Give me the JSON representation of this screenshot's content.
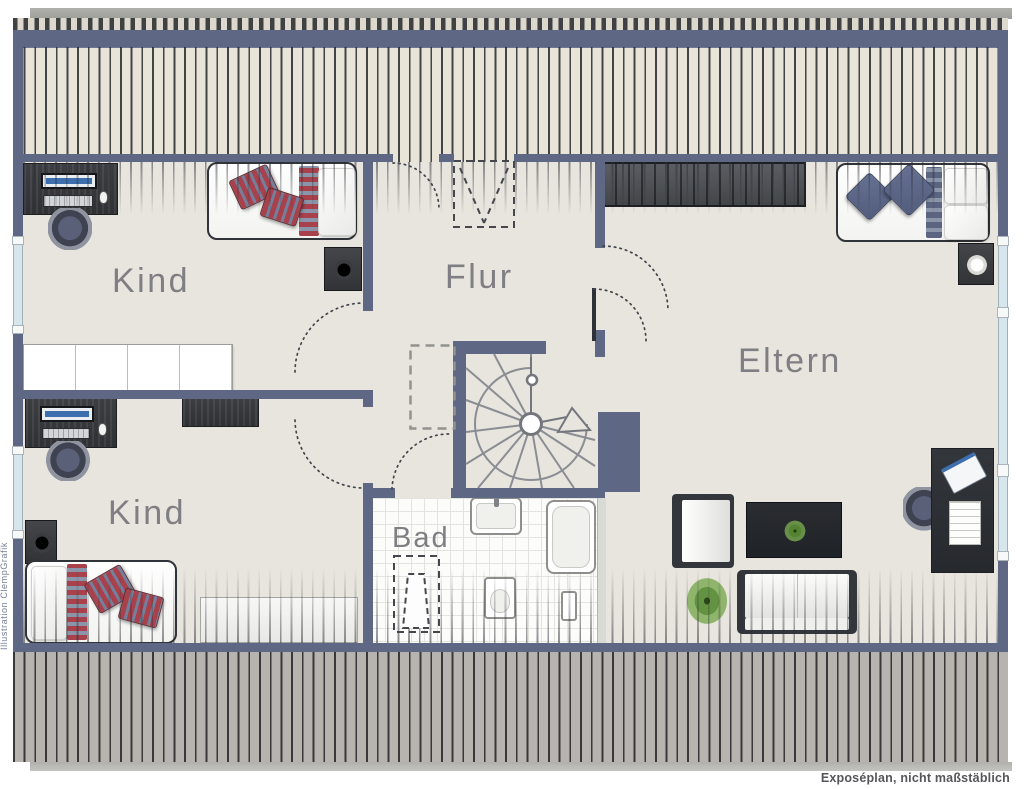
{
  "plan": {
    "kind": "floor-plan"
  },
  "rooms": {
    "kind_top": {
      "label": "Kind"
    },
    "kind_bottom": {
      "label": "Kind"
    },
    "flur": {
      "label": "Flur"
    },
    "bad": {
      "label": "Bad"
    },
    "eltern": {
      "label": "Eltern"
    }
  },
  "annotations": {
    "footer_note": "Exposéplan, nicht maßstäblich",
    "watermark": "Illustration ClempGrafik"
  },
  "colors": {
    "wall": "#5e6783",
    "floor": "#e8e5de",
    "roof_hatch_top": "#e9e4d8",
    "roof_hatch_bottom": "#b7b4af",
    "window_glazing": "#d6e6ec",
    "label_text": "#7f7f83",
    "textile_red": "#a8414b",
    "textile_blue": "#5b6480",
    "plant_green": "#6da03f"
  },
  "furniture": {
    "kind_top": [
      "desk with monitor",
      "office chair",
      "single bed",
      "nightstand with lamp",
      "white shelf unit"
    ],
    "kind_bottom": [
      "desk with monitor",
      "office chair",
      "wall shelf",
      "nightstand with lamp",
      "single bed",
      "white dresser"
    ],
    "flur": [
      "spiral staircase",
      "roof window",
      "void (dashed)"
    ],
    "bad": [
      "sink",
      "bathtub",
      "toilet",
      "roof window"
    ],
    "eltern": [
      "wardrobe",
      "double bed",
      "nightstand with lamp",
      "armchair",
      "coffee table with plant",
      "desk with laptop",
      "office chair",
      "sofa",
      "plant"
    ]
  }
}
